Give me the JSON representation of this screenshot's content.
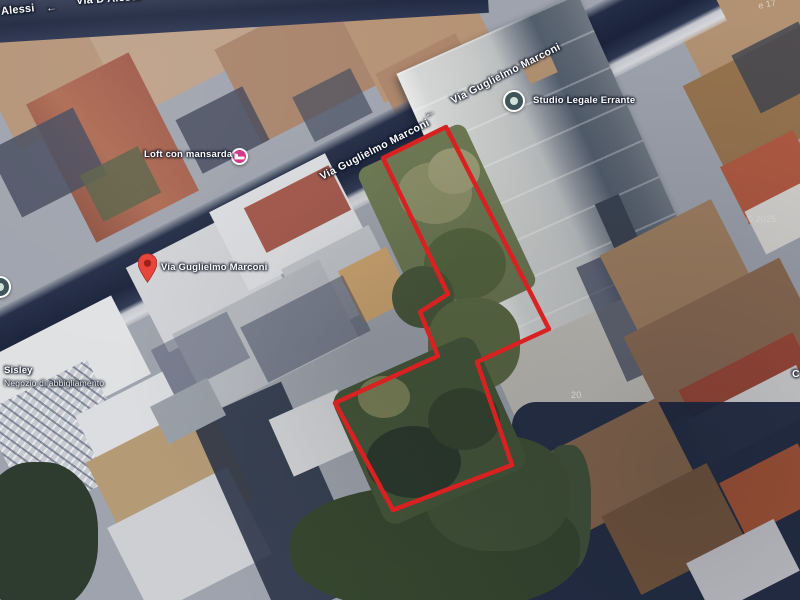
{
  "street_labels": {
    "top_left_corner": "Alessi",
    "top_street": "Via D'Alessi",
    "marconi_mid": "Via Guglielmo Marconi",
    "marconi_top": "Via Guglielmo Marconi"
  },
  "poi": {
    "loft": "Loft con mansarda",
    "studio_legale": "Studio Legale Errante",
    "sisley_name": "Sisley",
    "sisley_category": "Negozio di abbigliamento"
  },
  "marker": {
    "label": "Via Guglielmo Marconi"
  },
  "fragments": {
    "watermark": "© 2025",
    "right_edge": "C",
    "top_right_edge": "e 17",
    "house_number": "20"
  },
  "icons": {
    "left_arrow_glyph": "←",
    "pin": "red-map-pin",
    "loft": "lodging-poi-pink-circle",
    "studio_legale": "generic-poi-circle",
    "left_edge_poi": "generic-poi-circle"
  },
  "polygon": {
    "points": "446,127 549,329 477,362 512,465 393,510 335,403 438,356 420,312 448,294 383,158",
    "stroke_width": "4.5"
  },
  "palette": {
    "polygon_red": "#d92121",
    "pin_red": "#e8453c",
    "pin_red_dark": "#99231b",
    "poi_lodging_pink": "#d5378c",
    "poi_generic": "#3f545a",
    "poi_generic_dot": "#cfe3da",
    "road_shadow_navy": "#1f2840",
    "sidewalk_light": "#d6d7db",
    "vegetation_dark": "#36452f",
    "vegetation_mid": "#55663f",
    "roof_rust": "#9e5848",
    "roof_tan": "#b29272",
    "building_gray": "#c6c8c7",
    "label_white": "#ffffff"
  }
}
